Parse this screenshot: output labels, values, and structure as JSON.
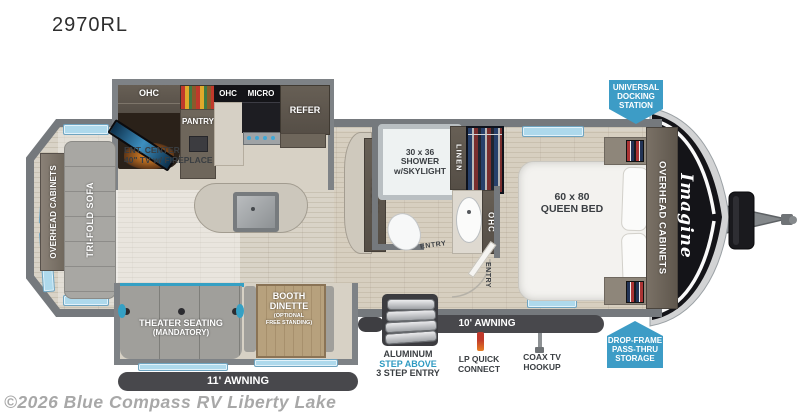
{
  "title": "2970RL",
  "watermark": "©2026 Blue Compass RV Liberty Lake",
  "brand": {
    "logo": "Imagine"
  },
  "colors": {
    "callout_blue": "#3d9cc6",
    "awning_dark": "#48484c",
    "step_above_blue": "#2f9ac1",
    "window_blue": "#aed9ec",
    "accent_teal": "#35a0c4"
  },
  "kitchen": {
    "ohc_left": "OHC",
    "ohc_right": "OHC",
    "micro": "MICRO",
    "refer": "REFER",
    "pantry": "PANTRY",
    "ent_line1": "ENT. CENTER",
    "ent_line2": "40\" TV w/ FIREPLACE"
  },
  "living": {
    "overhead_cabinets": "OVERHEAD CABINETS",
    "sofa": "TRI-FOLD SOFA",
    "theater_line1": "THEATER SEATING",
    "theater_line2": "(MANDATORY)",
    "dinette_line1": "BOOTH",
    "dinette_line2": "DINETTE",
    "dinette_line3": "(OPTIONAL",
    "dinette_line4": "FREE STANDING)"
  },
  "bath": {
    "shower_line1": "30 x 36",
    "shower_line2": "SHOWER",
    "shower_line3": "w/SKYLIGHT",
    "linen": "LINEN",
    "hutch": "HUTCH",
    "ohc": "OHC",
    "entry": "ENTRY"
  },
  "bedroom": {
    "bed_line1": "60 x 80",
    "bed_line2": "QUEEN BED",
    "overhead_cabinets": "OVERHEAD CABINETS",
    "entry": "ENTRY"
  },
  "callouts": {
    "docking_line1": "UNIVERSAL",
    "docking_line2": "DOCKING",
    "docking_line3": "STATION",
    "storage_line1": "DROP-FRAME",
    "storage_line2": "PASS-THRU",
    "storage_line3": "STORAGE"
  },
  "exterior": {
    "awning_rear": "11' AWNING",
    "awning_front": "10' AWNING",
    "steps_line1": "ALUMINUM",
    "steps_line2": "STEP ABOVE",
    "steps_line3": "3 STEP ENTRY",
    "lp_line1": "LP QUICK",
    "lp_line2": "CONNECT",
    "coax_line1": "COAX TV",
    "coax_line2": "HOOKUP"
  }
}
